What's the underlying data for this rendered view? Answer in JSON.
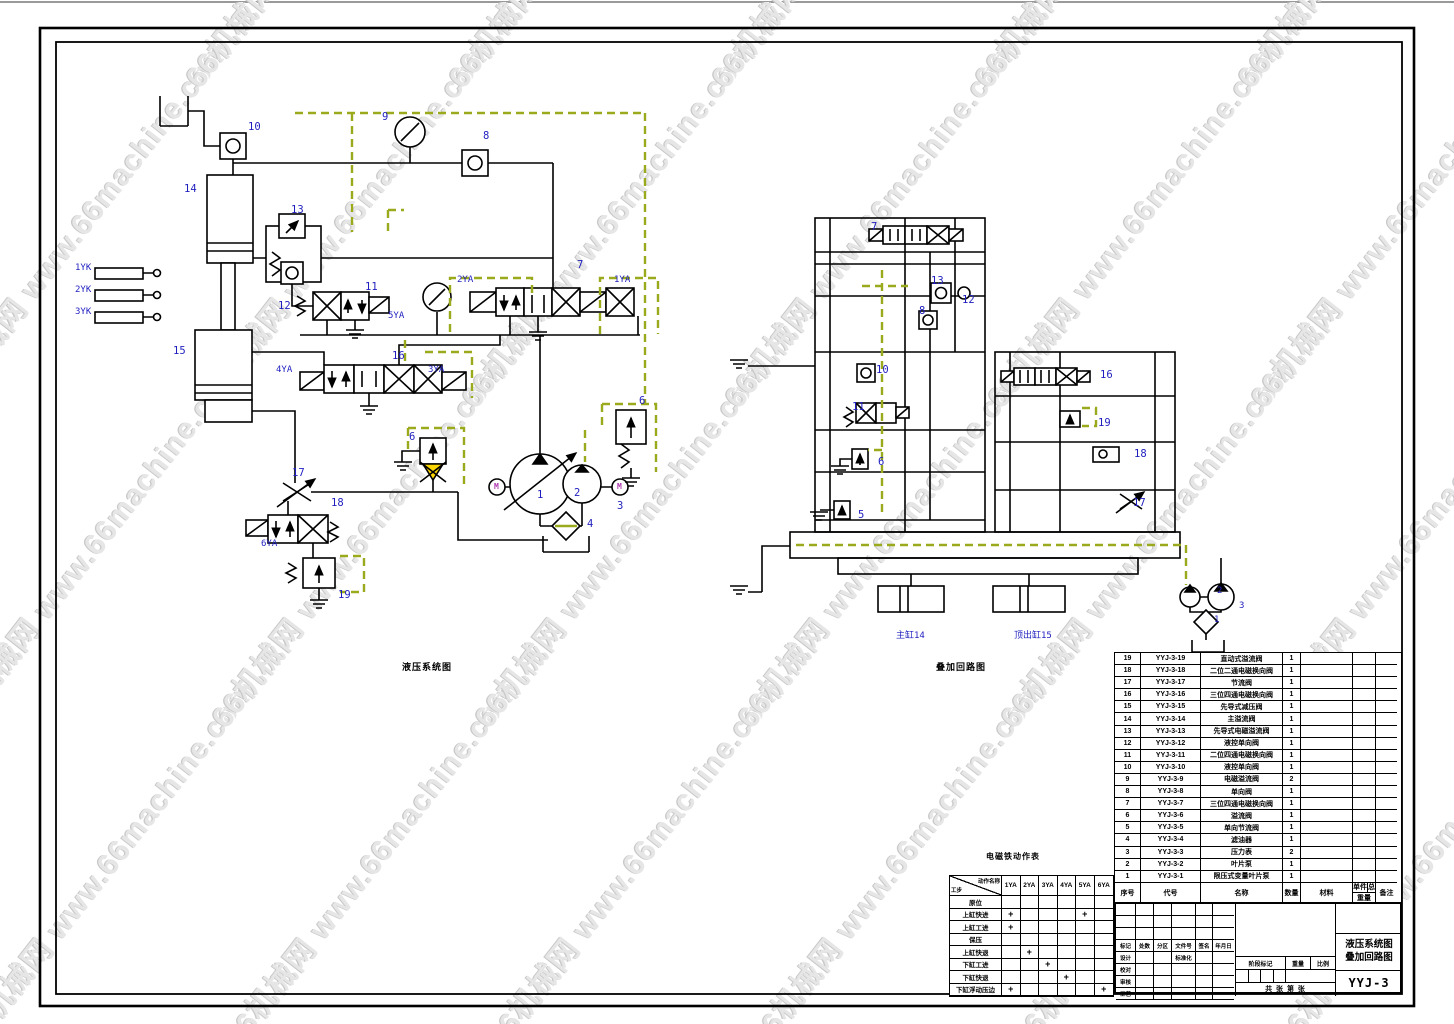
{
  "watermark": {
    "text": "66机械网 www.66machine.com",
    "color": "#e6e6e6"
  },
  "colors": {
    "line": "#000000",
    "label_blue": "#1f1fbf",
    "module_dash_olive": "#9aaa1c",
    "motor_magenta": "#b13db1",
    "filter_yellow": "#ffd700"
  },
  "titleblock": {
    "row_labels": [
      "标记",
      "处数",
      "分区",
      "文件号",
      "签名",
      "年月日"
    ],
    "left_rows": [
      "设计",
      "校对",
      "审核",
      "工艺"
    ],
    "standard_cell": "标准化",
    "stage_label": "阶段标记",
    "weight_label": "重量",
    "scale_label": "比例",
    "sheet_label": "共 张 第 张",
    "title_line1": "液压系统图",
    "title_line2": "叠加回路图",
    "drawing_no": "YYJ-3"
  },
  "parts_list": {
    "headers": {
      "seq": "序号",
      "code": "代号",
      "name": "名称",
      "qty": "数量",
      "material": "材料",
      "unit": "单件",
      "total": "总计",
      "weight": "重量",
      "remark": "备注"
    },
    "rows": [
      {
        "seq": "19",
        "code": "YYJ-3-19",
        "name": "直动式溢流阀",
        "qty": "1"
      },
      {
        "seq": "18",
        "code": "YYJ-3-18",
        "name": "二位二通电磁换向阀",
        "qty": "1"
      },
      {
        "seq": "17",
        "code": "YYJ-3-17",
        "name": "节流阀",
        "qty": "1"
      },
      {
        "seq": "16",
        "code": "YYJ-3-16",
        "name": "三位四通电磁换向阀",
        "qty": "1"
      },
      {
        "seq": "15",
        "code": "YYJ-3-15",
        "name": "先导式减压阀",
        "qty": "1"
      },
      {
        "seq": "14",
        "code": "YYJ-3-14",
        "name": "主溢流阀",
        "qty": "1"
      },
      {
        "seq": "13",
        "code": "YYJ-3-13",
        "name": "先导式电磁溢流阀",
        "qty": "1"
      },
      {
        "seq": "12",
        "code": "YYJ-3-12",
        "name": "液控单向阀",
        "qty": "1"
      },
      {
        "seq": "11",
        "code": "YYJ-3-11",
        "name": "二位四通电磁换向阀",
        "qty": "1"
      },
      {
        "seq": "10",
        "code": "YYJ-3-10",
        "name": "液控单向阀",
        "qty": "1"
      },
      {
        "seq": "9",
        "code": "YYJ-3-9",
        "name": "电磁溢流阀",
        "qty": "2"
      },
      {
        "seq": "8",
        "code": "YYJ-3-8",
        "name": "单向阀",
        "qty": "1"
      },
      {
        "seq": "7",
        "code": "YYJ-3-7",
        "name": "三位四通电磁换向阀",
        "qty": "1"
      },
      {
        "seq": "6",
        "code": "YYJ-3-6",
        "name": "溢流阀",
        "qty": "1"
      },
      {
        "seq": "5",
        "code": "YYJ-3-5",
        "name": "单向节流阀",
        "qty": "1"
      },
      {
        "seq": "4",
        "code": "YYJ-3-4",
        "name": "滤油器",
        "qty": "1"
      },
      {
        "seq": "3",
        "code": "YYJ-3-3",
        "name": "压力表",
        "qty": "2"
      },
      {
        "seq": "2",
        "code": "YYJ-3-2",
        "name": "叶片泵",
        "qty": "1"
      },
      {
        "seq": "1",
        "code": "YYJ-3-1",
        "name": "限压式变量叶片泵",
        "qty": "1"
      }
    ]
  },
  "action_table": {
    "title": "电磁铁动作表",
    "corner_top": "动作名称",
    "corner_bottom": "工步",
    "columns": [
      "1YA",
      "2YA",
      "3YA",
      "4YA",
      "5YA",
      "6YA"
    ],
    "mark": "+",
    "rows": [
      {
        "name": "原位",
        "marks": []
      },
      {
        "name": "上缸快进",
        "marks": [
          "1YA",
          "5YA"
        ]
      },
      {
        "name": "上缸工进",
        "marks": [
          "1YA"
        ]
      },
      {
        "name": "保压",
        "marks": []
      },
      {
        "name": "上缸快退",
        "marks": [
          "2YA"
        ]
      },
      {
        "name": "下缸工进",
        "marks": [
          "3YA"
        ]
      },
      {
        "name": "下缸快退",
        "marks": [
          "4YA"
        ]
      },
      {
        "name": "下缸浮动压边",
        "marks": [
          "1YA",
          "6YA"
        ]
      }
    ]
  },
  "annotations": [
    {
      "t": "10",
      "x": 248,
      "y": 122
    },
    {
      "t": "9",
      "x": 382,
      "y": 112
    },
    {
      "t": "8",
      "x": 483,
      "y": 131
    },
    {
      "t": "14",
      "x": 184,
      "y": 184
    },
    {
      "t": "13",
      "x": 291,
      "y": 205
    },
    {
      "t": "12",
      "x": 278,
      "y": 301
    },
    {
      "t": "11",
      "x": 365,
      "y": 282
    },
    {
      "t": "5YA",
      "x": 388,
      "y": 312,
      "s": 9
    },
    {
      "t": "2YA",
      "x": 457,
      "y": 276,
      "s": 9
    },
    {
      "t": "7",
      "x": 577,
      "y": 260
    },
    {
      "t": "1YA",
      "x": 614,
      "y": 276,
      "s": 9
    },
    {
      "t": "1YK",
      "x": 75,
      "y": 264,
      "s": 9
    },
    {
      "t": "2YK",
      "x": 75,
      "y": 286,
      "s": 9
    },
    {
      "t": "3YK",
      "x": 75,
      "y": 308,
      "s": 9
    },
    {
      "t": "15",
      "x": 173,
      "y": 346
    },
    {
      "t": "4YA",
      "x": 276,
      "y": 366,
      "s": 9
    },
    {
      "t": "16",
      "x": 392,
      "y": 351
    },
    {
      "t": "3YA",
      "x": 428,
      "y": 366,
      "s": 9
    },
    {
      "t": "6",
      "x": 639,
      "y": 396
    },
    {
      "t": "6",
      "x": 409,
      "y": 432
    },
    {
      "t": "17",
      "x": 292,
      "y": 468
    },
    {
      "t": "18",
      "x": 331,
      "y": 498
    },
    {
      "t": "6YA",
      "x": 261,
      "y": 540,
      "s": 9
    },
    {
      "t": "19",
      "x": 338,
      "y": 590
    },
    {
      "t": "1",
      "x": 537,
      "y": 490
    },
    {
      "t": "2",
      "x": 574,
      "y": 488
    },
    {
      "t": "3",
      "x": 617,
      "y": 501
    },
    {
      "t": "4",
      "x": 587,
      "y": 519
    },
    {
      "t": "M",
      "x": 494,
      "y": 483,
      "c": "mag",
      "s": 8,
      "n": "motor-label"
    },
    {
      "t": "M",
      "x": 617,
      "y": 483,
      "c": "mag",
      "s": 8,
      "n": "motor-label"
    },
    {
      "t": "7",
      "x": 871,
      "y": 222
    },
    {
      "t": "13",
      "x": 931,
      "y": 276
    },
    {
      "t": "12",
      "x": 962,
      "y": 295
    },
    {
      "t": "8",
      "x": 919,
      "y": 306
    },
    {
      "t": "10",
      "x": 876,
      "y": 365
    },
    {
      "t": "11",
      "x": 852,
      "y": 402
    },
    {
      "t": "16",
      "x": 1100,
      "y": 370
    },
    {
      "t": "19",
      "x": 1098,
      "y": 418
    },
    {
      "t": "18",
      "x": 1134,
      "y": 449
    },
    {
      "t": "17",
      "x": 1133,
      "y": 498
    },
    {
      "t": "6",
      "x": 878,
      "y": 457
    },
    {
      "t": "5",
      "x": 858,
      "y": 510
    },
    {
      "t": "2",
      "x": 1217,
      "y": 587,
      "s": 9
    },
    {
      "t": "1",
      "x": 1214,
      "y": 616,
      "s": 9
    },
    {
      "t": "3",
      "x": 1239,
      "y": 602,
      "s": 9
    },
    {
      "t": "主缸14",
      "x": 896,
      "y": 632,
      "s": 9,
      "n": "cylinder-label-main"
    },
    {
      "t": "顶出缸15",
      "x": 1014,
      "y": 632,
      "s": 9,
      "n": "cylinder-label-ejector"
    },
    {
      "t": "液压系统图",
      "x": 402,
      "y": 664,
      "c": "black",
      "s": 9,
      "n": "caption-left-diagram"
    },
    {
      "t": "叠加回路图",
      "x": 936,
      "y": 664,
      "c": "black",
      "s": 9,
      "n": "caption-right-diagram"
    },
    {
      "t": "电磁铁动作表",
      "x": 986,
      "y": 853,
      "c": "black",
      "s": 8,
      "n": "caption-action-table"
    }
  ]
}
